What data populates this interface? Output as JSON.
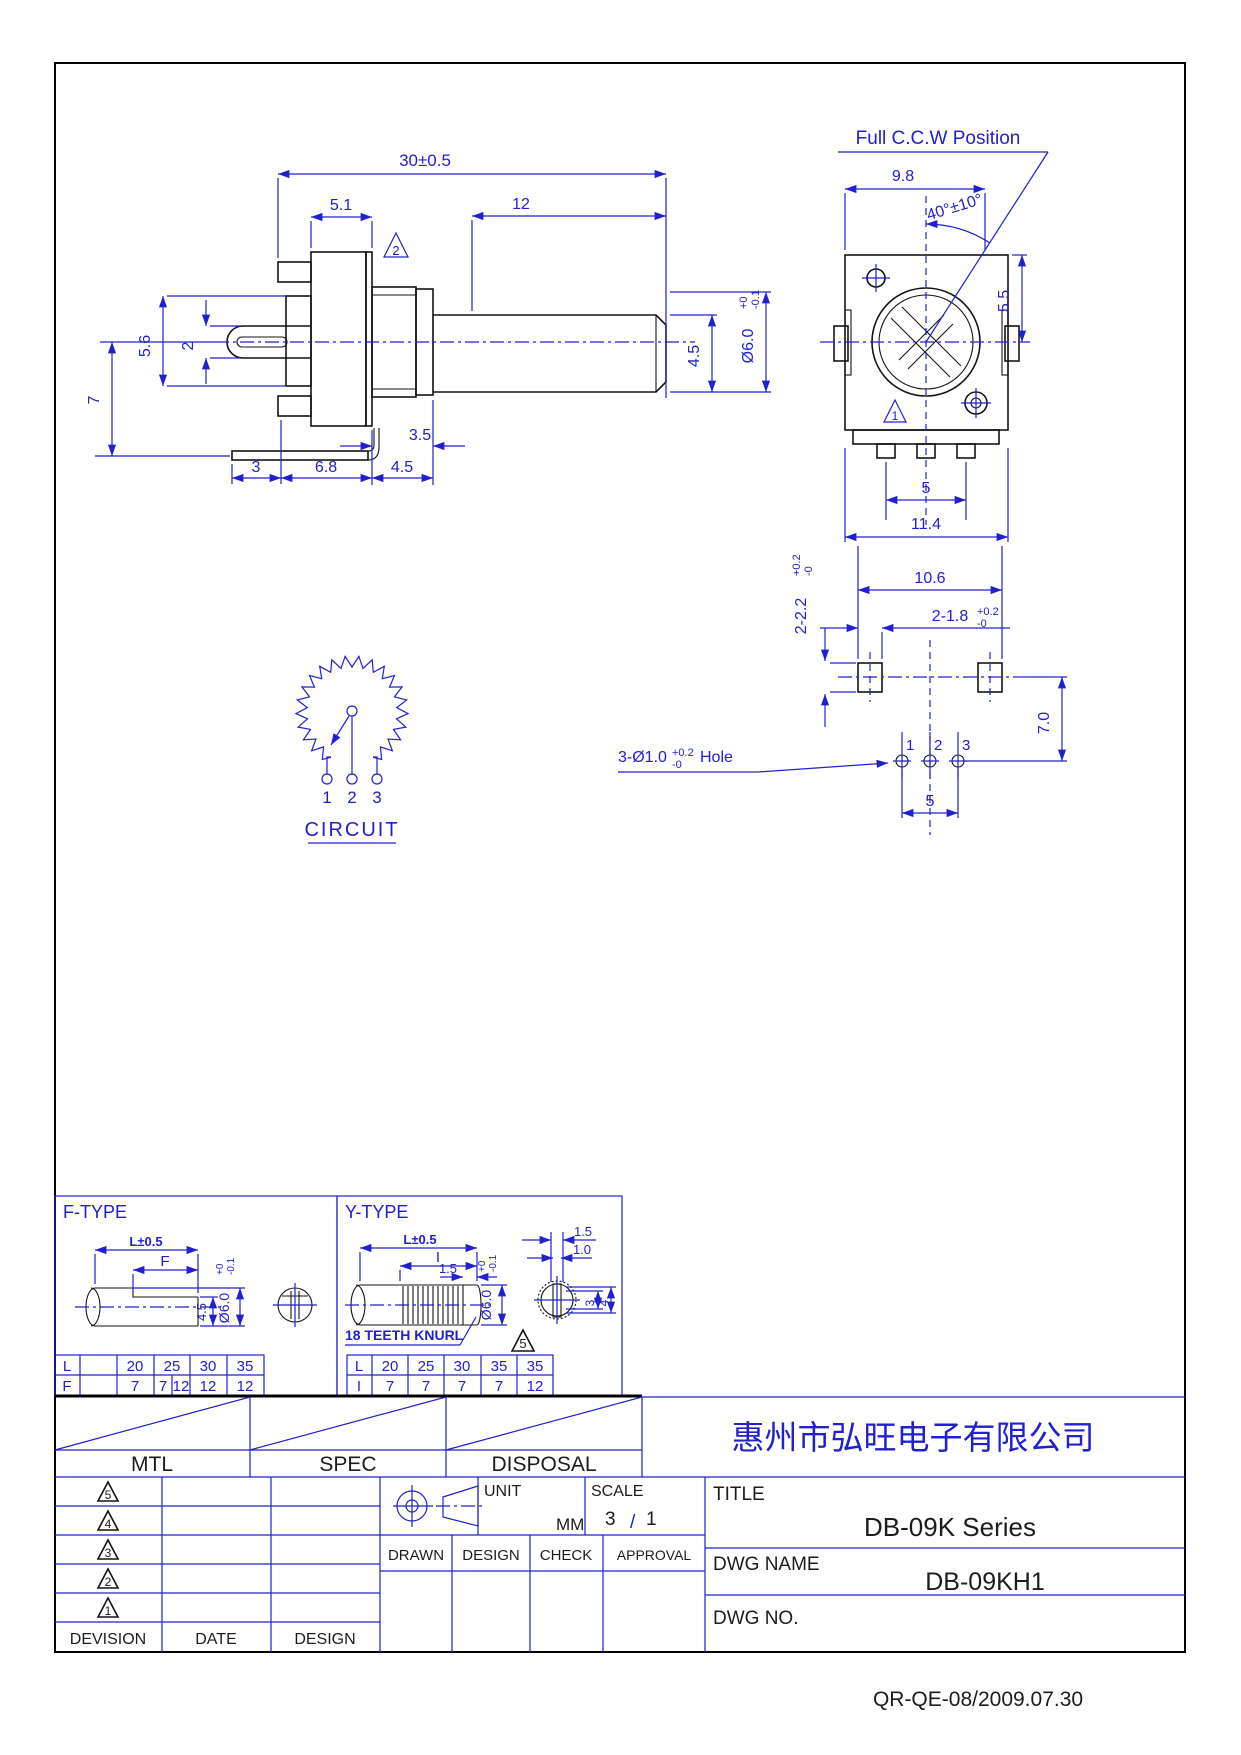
{
  "page": {
    "footer": "QR-QE-08/2009.07.30"
  },
  "side_view": {
    "dim_width": "30±0.5",
    "dim_51": "5.1",
    "dim_12": "12",
    "dim_56": "5.6",
    "dim_2": "2",
    "dim_7": "7",
    "dim_35": "3.5",
    "dim_3": "3",
    "dim_68": "6.8",
    "dim_45_bottom": "4.5",
    "dim_45_shaft": "4.5",
    "dia_main": "Ø6.0",
    "dia_tol_top": "+0",
    "dia_tol_bot": "-0.1",
    "rev_triangle": "2"
  },
  "front_view": {
    "title": "Full C.C.W Position",
    "dim_98": "9.8",
    "dim_angle": "40°±10°",
    "dim_55": "5.5",
    "dim_5": "5",
    "dim_114": "11.4",
    "rev_triangle": "1"
  },
  "pcb_view": {
    "dim_106": "10.6",
    "dim_18": "2-1.8",
    "dim_18_tol_top": "+0.2",
    "dim_18_tol_bot": "-0",
    "dim_22": "2-2.2",
    "dim_22_tol_top": "+0.2",
    "dim_22_tol_bot": "-0",
    "dim_70": "7.0",
    "dim_5": "5",
    "hole_note": "3-Ø1.0",
    "hole_note_tol_top": "+0.2",
    "hole_note_tol_bot": "-0",
    "hole_note_suffix": "Hole",
    "pin1": "1",
    "pin2": "2",
    "pin3": "3"
  },
  "circuit": {
    "label": "CIRCUIT",
    "pin1": "1",
    "pin2": "2",
    "pin3": "3"
  },
  "f_type": {
    "label": "F-TYPE",
    "dim_l": "L±0.5",
    "dim_f": "F",
    "dia_main": "Ø6.0",
    "dia_tol_top": "+0",
    "dia_tol_bot": "-0.1",
    "dim_45": "4.5",
    "row_l": [
      "L",
      "",
      "20",
      "25",
      "30",
      "35"
    ],
    "row_f": [
      "F",
      "",
      "7",
      "7",
      "12",
      "12",
      "12"
    ]
  },
  "y_type": {
    "label": "Y-TYPE",
    "dim_l": "L±0.5",
    "dim_i": "I",
    "dim_15": "1.5",
    "dia_main": "Ø6.0",
    "dia_tol_top": "+0",
    "dia_tol_bot": "-0.1",
    "knurl_note": "18 TEETH KNURL",
    "rev_triangle": "5",
    "front_15": "1.5",
    "front_10": "1.0",
    "front_3": "3",
    "front_4": "4",
    "row_l": [
      "L",
      "20",
      "25",
      "30",
      "35",
      "35"
    ],
    "row_i": [
      "I",
      "7",
      "7",
      "7",
      "7",
      "12"
    ]
  },
  "title_block": {
    "mtl": "MTL",
    "spec": "SPEC",
    "disposal": "DISPOSAL",
    "rev_rows": [
      "5",
      "4",
      "3",
      "2",
      "1"
    ],
    "devision": "DEVISION",
    "date": "DATE",
    "design": "DESIGN",
    "unit_label": "UNIT",
    "unit_value": "MM",
    "scale_label": "SCALE",
    "scale_num": "3",
    "scale_sep": "/",
    "scale_den": "1",
    "drawn": "DRAWN",
    "design2": "DESIGN",
    "check": "CHECK",
    "approval": "APPROVAL",
    "company": "惠州市弘旺电子有限公司",
    "title_label": "TITLE",
    "title_value": "DB-09K Series",
    "dwg_name_label": "DWG NAME",
    "dwg_name_value": "DB-09KH1",
    "dwg_no_label": "DWG NO."
  }
}
